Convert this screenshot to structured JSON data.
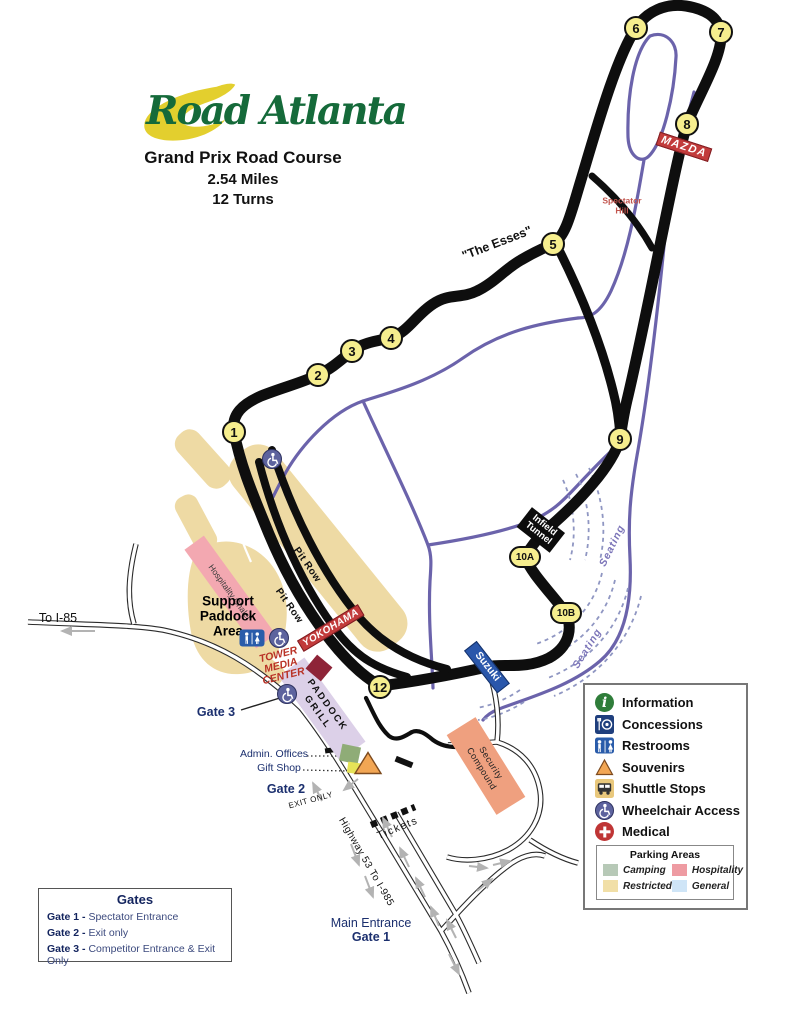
{
  "header": {
    "logo": "Road Atlanta",
    "course": "Grand Prix Road Course",
    "distance": "2.54 Miles",
    "turns_count": "12 Turns"
  },
  "track": {
    "turns": [
      {
        "label": "1",
        "x": 234,
        "y": 432
      },
      {
        "label": "2",
        "x": 318,
        "y": 375
      },
      {
        "label": "3",
        "x": 352,
        "y": 351
      },
      {
        "label": "4",
        "x": 391,
        "y": 338
      },
      {
        "label": "5",
        "x": 553,
        "y": 244
      },
      {
        "label": "6",
        "x": 636,
        "y": 28
      },
      {
        "label": "7",
        "x": 721,
        "y": 32
      },
      {
        "label": "8",
        "x": 687,
        "y": 124
      },
      {
        "label": "9",
        "x": 620,
        "y": 439
      },
      {
        "label": "10A",
        "x": 525,
        "y": 557,
        "wide": true
      },
      {
        "label": "10B",
        "x": 566,
        "y": 613,
        "wide": true
      },
      {
        "label": "12",
        "x": 380,
        "y": 687
      }
    ],
    "labels": {
      "esses": "\"The Esses\"",
      "pit_row_1": "Pit Row",
      "pit_row_2": "Pit Row",
      "seating_1": "Seating",
      "seating_2": "Seating",
      "spectator_hill": [
        "Spectator",
        "Hill"
      ],
      "infield_tunnel": [
        "Infield",
        "Tunnel"
      ],
      "mazda": "MAZDA",
      "yokohama": "YOKOHAMA",
      "suzuki": "Suzuki"
    }
  },
  "facilities": {
    "hospitality_chalet": "Hospitality Chalet",
    "support_paddock": [
      "Support",
      "Paddock",
      "Area"
    ],
    "paddock_grill": [
      "PADDOCK",
      "GRILL"
    ],
    "tower_media_center": [
      "TOWER",
      "MEDIA",
      "CENTER"
    ],
    "admin_offices": "Admin. Offices",
    "gift_shop": "Gift Shop",
    "security_compound": [
      "Security",
      "Compound"
    ],
    "tickets": "Tickets"
  },
  "roads": {
    "to_i85": "To I-85",
    "highway": "Highway 53 To I-985",
    "exit_only": "EXIT ONLY",
    "main_entrance": "Main Entrance",
    "main_entrance_gate": "Gate 1",
    "gate2": "Gate 2",
    "gate3": "Gate 3"
  },
  "legend": {
    "items": [
      {
        "icon": "information-icon",
        "label": "Information"
      },
      {
        "icon": "concessions-icon",
        "label": "Concessions"
      },
      {
        "icon": "restrooms-icon",
        "label": "Restrooms"
      },
      {
        "icon": "souvenirs-icon",
        "label": "Souvenirs"
      },
      {
        "icon": "shuttle-stops-icon",
        "label": "Shuttle Stops"
      },
      {
        "icon": "wheelchair-access-icon",
        "label": "Wheelchair Access"
      },
      {
        "icon": "medical-icon",
        "label": "Medical"
      }
    ],
    "parking": {
      "title": "Parking Areas",
      "areas": [
        {
          "label": "Camping",
          "color": "#b7c9b7"
        },
        {
          "label": "Hospitality",
          "color": "#ee9ba2"
        },
        {
          "label": "Restricted",
          "color": "#f1dfa7"
        },
        {
          "label": "General",
          "color": "#cfe5f7"
        }
      ]
    }
  },
  "gates_box": {
    "title": "Gates",
    "items": [
      {
        "name": "Gate 1 -",
        "desc": "Spectator Entrance"
      },
      {
        "name": "Gate 2 -",
        "desc": "Exit only"
      },
      {
        "name": "Gate 3 -",
        "desc": "Competitor Entrance & Exit Only"
      }
    ]
  },
  "colors": {
    "track": "#0e0e0e",
    "access_road": "#6b63ab",
    "turn_badge": "#f6ee8e",
    "restricted_parking": "#eedaa4",
    "hospitality_pink": "#f3a8b1",
    "banner_red": "#c23b3b",
    "suzuki_blue": "#2a57ab",
    "navy_text": "#1b2f6e"
  }
}
